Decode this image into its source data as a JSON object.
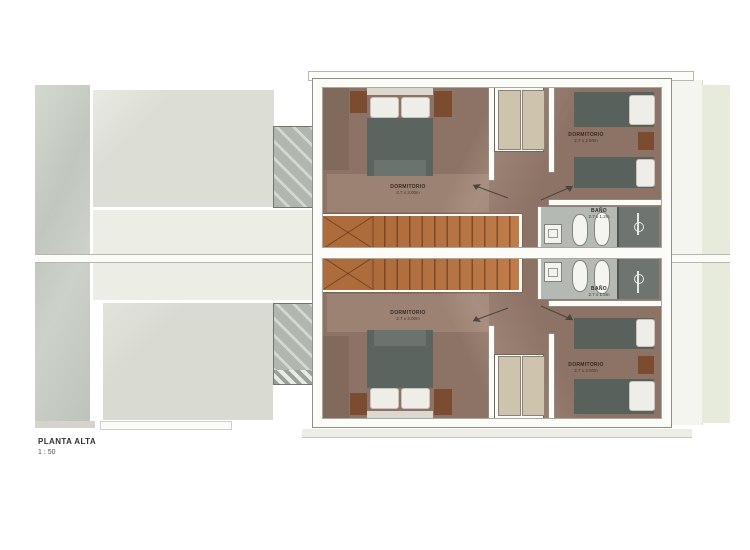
{
  "title_block": {
    "title": "PLANTA ALTA",
    "scale": "1 : 50"
  },
  "units": {
    "top": {
      "bedroom_main": {
        "name": "DORMITORIO",
        "dims": "2.7 x 3.00m"
      },
      "bedroom_second": {
        "name": "DORMITORIO",
        "dims": "2.7 x 2.50m"
      },
      "bathroom": {
        "name": "BAÑO",
        "dims": "2.7 x 1.2m"
      }
    },
    "bottom": {
      "bedroom_main": {
        "name": "DORMITORIO",
        "dims": "2.7 x 3.00m"
      },
      "bedroom_second": {
        "name": "DORMITORIO",
        "dims": "2.7 x 2.50m"
      },
      "bathroom": {
        "name": "BAÑO",
        "dims": "2.7 x 1.2m"
      }
    }
  },
  "colors": {
    "bedroom_floor": "#8d7365",
    "stairs_wood": "#ae6c3c",
    "bed_cover": "#5c6460",
    "bathroom_floor": "#b5b9b3",
    "shower_floor": "#6e7470",
    "wardrobe": "#cec4ad",
    "exterior_roof": "#dcddd5",
    "exterior_green": "#e7ebdb",
    "wall": "#fbfbf7"
  }
}
